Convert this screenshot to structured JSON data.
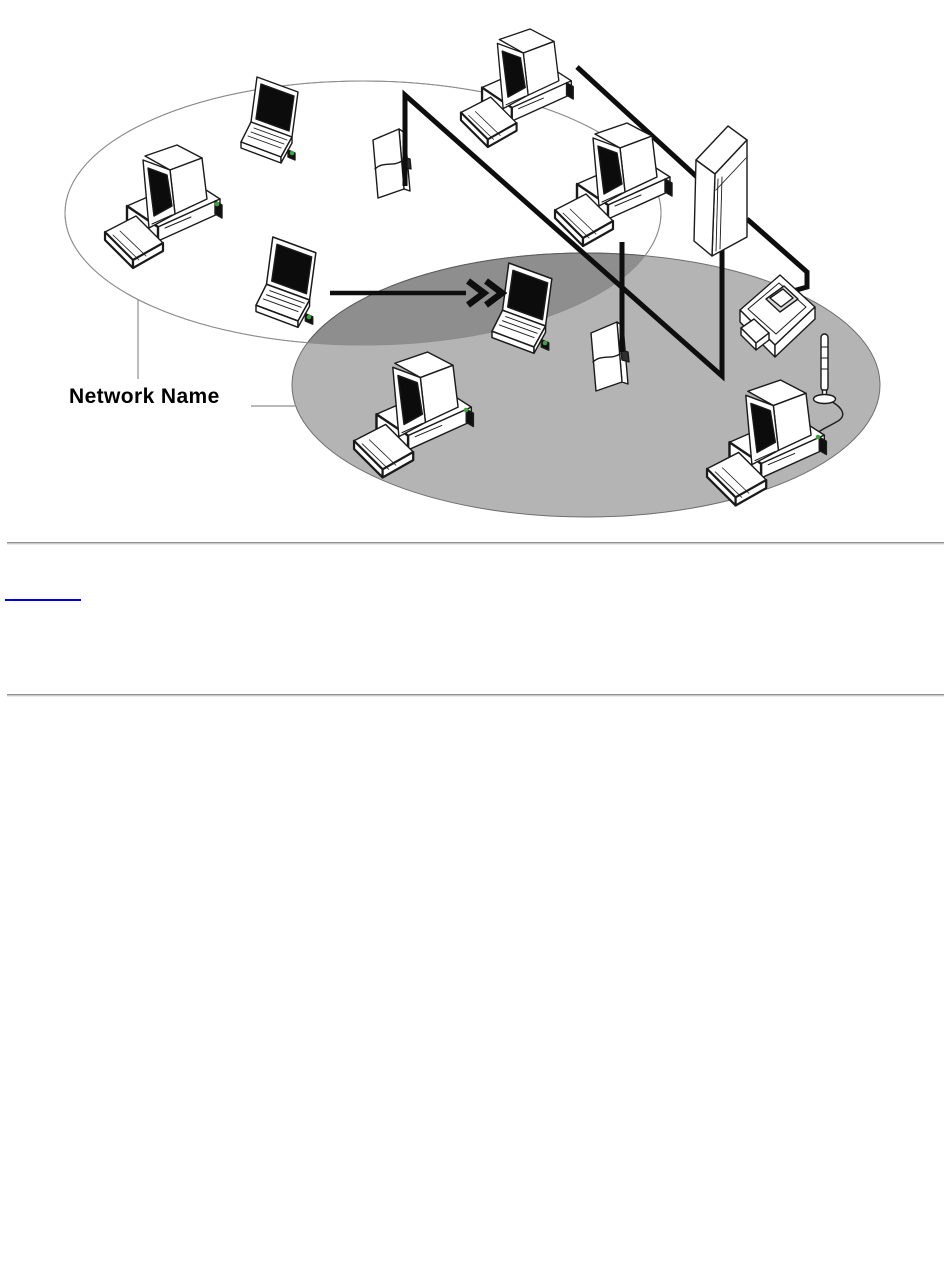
{
  "page": {
    "background": "#ffffff"
  },
  "diagram": {
    "label": "Network Name",
    "networks": [
      {
        "name": "network-1-ellipse",
        "cx": 363,
        "cy": 213,
        "rx": 298,
        "ry": 132,
        "fill": "#ffffff",
        "stroke": "#8c8c8c"
      },
      {
        "name": "network-2-ellipse",
        "cx": 586,
        "cy": 385,
        "rx": 294,
        "ry": 132,
        "fill": "#b4b4b4",
        "stroke": "#6e6e6e"
      }
    ],
    "overlap_fill": "#8e8e8e",
    "overlap_stroke": "#5a5a5a",
    "nodes": [
      {
        "name": "pc-card-1",
        "icon": "pc-card",
        "x": 370,
        "y": 127,
        "s": 1.0,
        "layer": "under"
      },
      {
        "name": "pc-card-2",
        "icon": "pc-card",
        "x": 588,
        "y": 320,
        "s": 1.0,
        "layer": "under"
      },
      {
        "name": "desktop-pc-1",
        "icon": "desktop-computer",
        "x": 103,
        "y": 144,
        "s": 1.0,
        "layer": "over"
      },
      {
        "name": "laptop-1",
        "icon": "laptop-computer",
        "x": 241,
        "y": 77,
        "s": 1.0,
        "layer": "over"
      },
      {
        "name": "laptop-2",
        "icon": "laptop-computer",
        "x": 256,
        "y": 237,
        "s": 1.05,
        "layer": "over"
      },
      {
        "name": "desktop-pc-2",
        "icon": "desktop-computer",
        "x": 459,
        "y": 28,
        "s": 0.96,
        "layer": "over"
      },
      {
        "name": "desktop-pc-3",
        "icon": "desktop-computer",
        "x": 553,
        "y": 122,
        "s": 1.0,
        "layer": "over"
      },
      {
        "name": "tower-unit-1",
        "icon": "tower-unit",
        "x": 692,
        "y": 124,
        "s": 1.0,
        "layer": "over"
      },
      {
        "name": "laptop-3",
        "icon": "laptop-computer",
        "x": 492,
        "y": 263,
        "s": 1.05,
        "layer": "over"
      },
      {
        "name": "printer-1",
        "icon": "printer",
        "x": 739,
        "y": 271,
        "s": 1.0,
        "layer": "over"
      },
      {
        "name": "antenna-1",
        "icon": "antenna",
        "x": 803,
        "y": 334,
        "s": 1.0,
        "layer": "over"
      },
      {
        "name": "desktop-pc-4",
        "icon": "desktop-computer",
        "x": 352,
        "y": 351,
        "s": 1.02,
        "layer": "over"
      },
      {
        "name": "desktop-pc-5",
        "icon": "desktop-computer",
        "x": 705,
        "y": 379,
        "s": 1.02,
        "layer": "over"
      }
    ],
    "cables": [
      {
        "name": "cable-card1-tower",
        "points": [
          [
            405,
            186
          ],
          [
            405,
            95
          ],
          [
            722,
            376
          ],
          [
            722,
            247
          ]
        ]
      },
      {
        "name": "cable-desktop2",
        "points": [
          [
            577,
            67
          ],
          [
            697,
            177
          ]
        ]
      },
      {
        "name": "cable-tower-printer",
        "points": [
          [
            747,
            219
          ],
          [
            807,
            272
          ],
          [
            807,
            287
          ],
          [
            793,
            291
          ]
        ]
      },
      {
        "name": "cable-desktop3-card2",
        "points": [
          [
            622,
            242
          ],
          [
            622,
            352
          ]
        ]
      }
    ],
    "antenna_cable_path": "M822,397 C842,405 848,415 838,421 C828,427 820,430 816,434",
    "arrow": {
      "x1": 330,
      "y1": 293,
      "x2": 466,
      "y2": 293,
      "chevrons": [
        [
          468,
          281,
          484,
          293,
          468,
          305
        ],
        [
          486,
          281,
          502,
          293,
          486,
          305
        ]
      ]
    },
    "label_leaders": [
      [
        138,
        300,
        138,
        379
      ],
      [
        251,
        406,
        296,
        406
      ]
    ],
    "wireless_dots": [
      [
        217,
        204
      ],
      [
        292,
        153
      ],
      [
        309,
        317
      ],
      [
        545,
        343
      ],
      [
        466,
        410
      ],
      [
        818,
        437
      ]
    ],
    "dot_color": "#3da43d"
  },
  "footer": {
    "link": {
      "text": "",
      "color": "#0000dd"
    }
  }
}
